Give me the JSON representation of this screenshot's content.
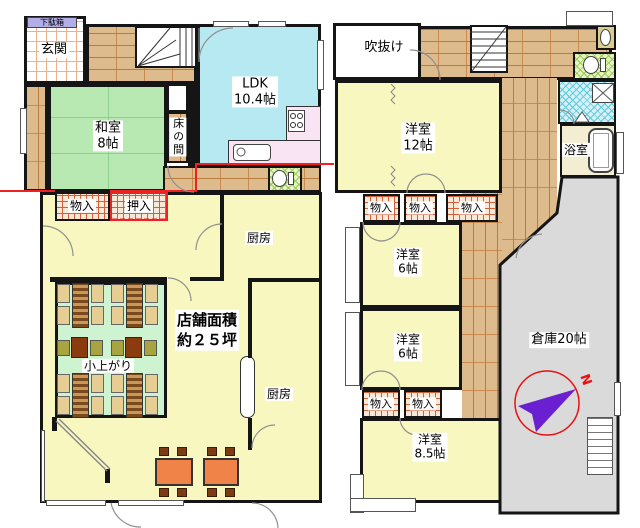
{
  "floor1": {
    "getabako": "下駄箱",
    "genkan": "玄関",
    "washitsu_name": "和室",
    "washitsu_size": "8帖",
    "ldk_name": "LDK",
    "ldk_size": "10.4帖",
    "tokonoma": "床の間",
    "monoiri": "物入",
    "oshiire": "押入",
    "kitchen_upper": "厨房",
    "shop_area_line1": "店舗面積",
    "shop_area_line2": "約２５坪",
    "koagari": "小上がり",
    "kitchen_lower": "厨房"
  },
  "floor2": {
    "fukinuke": "吹抜け",
    "room12_name": "洋室",
    "room12_size": "12帖",
    "monoiri_1": "物入",
    "monoiri_2": "物入",
    "monoiri_3": "物入",
    "room6a_name": "洋室",
    "room6a_size": "6帖",
    "room6b_name": "洋室",
    "room6b_size": "6帖",
    "monoiri_4": "物入",
    "monoiri_5": "物入",
    "room85_name": "洋室",
    "room85_size": "8.5帖",
    "bathroom": "浴室",
    "warehouse": "倉庫20帖",
    "compass_north": "N"
  },
  "colors": {
    "wall": "#151515",
    "tatami_green": "#b9e9b2",
    "ldk_cyan": "#b6e9f2",
    "room_yellow": "#f8f7bf",
    "wood_tan": "#debb8d",
    "mint_green": "#cdf3d0",
    "warehouse_gray": "#dadada",
    "kitchen_pink": "#f8e4f2",
    "storage_hatch": "#f8e8d8",
    "boundary_red": "#ee2222",
    "compass_purple": "#6a1fd0",
    "table_orange": "#ef8348"
  }
}
